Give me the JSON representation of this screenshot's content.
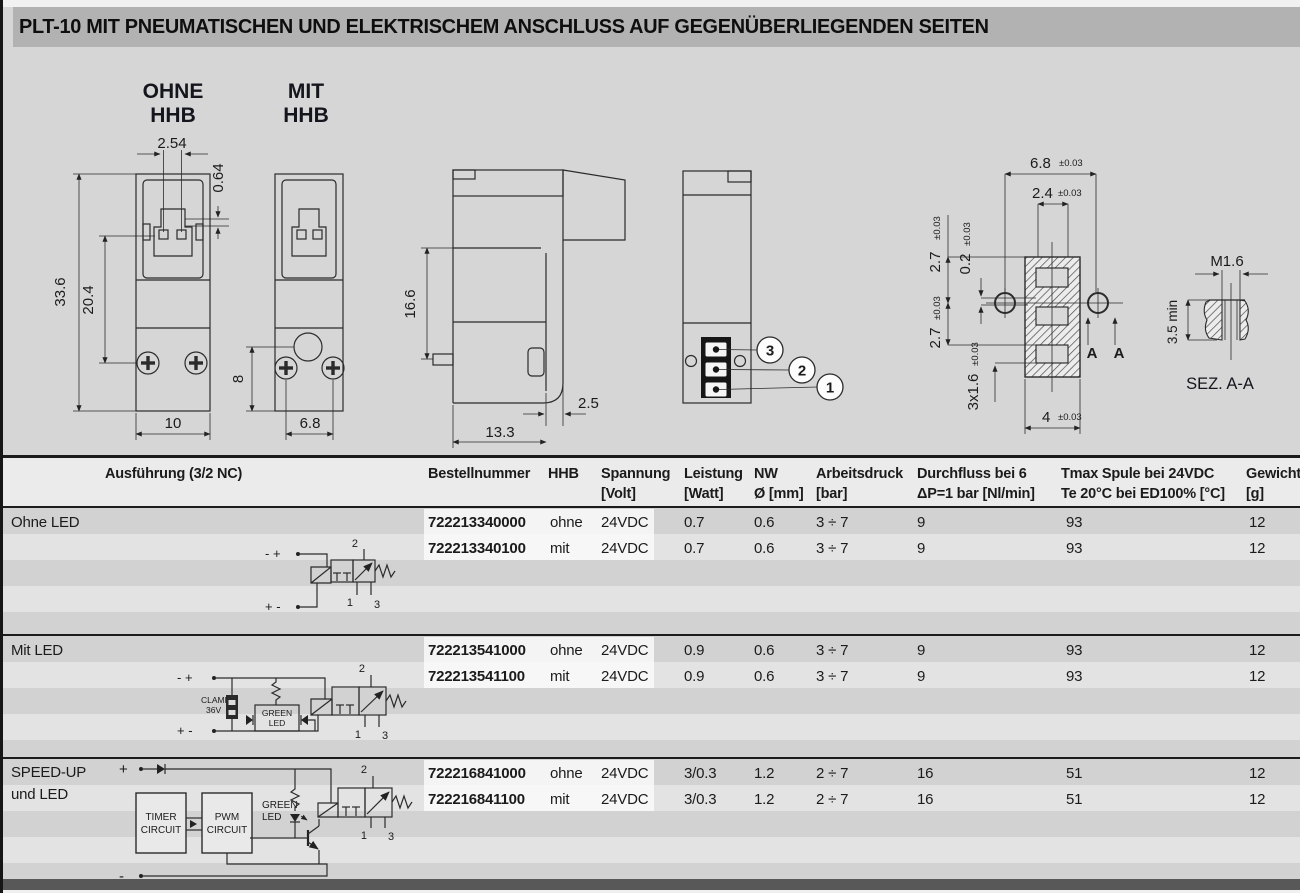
{
  "page": {
    "title": "PLT-10 MIT PNEUMATISCHEN UND ELEKTRISCHEM ANSCHLUSS AUF GEGENÜBERLIEGENDEN SEITEN"
  },
  "drawings": {
    "ohne": {
      "label1": "OHNE",
      "label2": "HHB",
      "dim_pin_spacing": "2.54",
      "dim_pin_height": "0.64",
      "dim_height": "33.6",
      "dim_inner_height": "20.4",
      "dim_width": "10"
    },
    "mit": {
      "label1": "MIT",
      "label2": "HHB",
      "dim_screw_offset": "8",
      "dim_screw_spacing": "6.8"
    },
    "side": {
      "dim_height": "16.6",
      "dim_offset": "2.5",
      "dim_depth": "13.3"
    },
    "ports": {
      "callout_3": "3",
      "callout_2": "2",
      "callout_1": "1"
    },
    "pattern": {
      "outer": {
        "v": "6.8",
        "tol": "±0.03"
      },
      "inner": {
        "v": "2.4",
        "tol": "±0.03"
      },
      "p1": {
        "v": "2.7",
        "tol": "±0.03"
      },
      "gap": {
        "v": "0.2",
        "tol": "±0.03"
      },
      "p2": {
        "v": "2.7",
        "tol": "±0.03"
      },
      "slots": {
        "v": "3x1.6",
        "tol": "±0.03"
      },
      "base": {
        "v": "4",
        "tol": "±0.03"
      },
      "sec_a1": "A",
      "sec_a2": "A"
    },
    "section": {
      "thread": "M1.6",
      "depth": "3.5 min",
      "caption": "SEZ. A-A"
    }
  },
  "schematics": {
    "s1": {
      "term_top": "- +",
      "term_bottom": "+ -",
      "port2": "2",
      "port1": "1",
      "port3": "3"
    },
    "s2": {
      "term_top": "- +",
      "term_bottom": "+ -",
      "clamp1": "CLAMP",
      "clamp2": "36V",
      "led1": "GREEN",
      "led2": "LED",
      "port2": "2",
      "port1": "1",
      "port3": "3"
    },
    "s3": {
      "term_top": "+",
      "term_bottom": "-",
      "timer1": "TIMER",
      "timer2": "CIRCUIT",
      "pwm1": "PWM",
      "pwm2": "CIRCUIT",
      "led1": "GREEN",
      "led2": "LED",
      "port2": "2",
      "port1": "1",
      "port3": "3"
    }
  },
  "table": {
    "headers": {
      "ausfuehrung": "Ausführung (3/2 NC)",
      "bestellnummer": "Bestellnummer",
      "hhb": "HHB",
      "spannung1": "Spannung",
      "spannung2": "[Volt]",
      "leistung1": "Leistung",
      "leistung2": "[Watt]",
      "nw1": "NW",
      "nw2": "Ø [mm]",
      "druck1": "Arbeitsdruck",
      "druck2": "[bar]",
      "fluss1": "Durchfluss bei 6",
      "fluss2": "ΔP=1 bar [Nl/min]",
      "tmax1": "Tmax Spule bei 24VDC",
      "tmax2": "Te 20°C bei  ED100% [°C]",
      "gewicht1": "Gewicht",
      "gewicht2": "[g]"
    },
    "groups": [
      {
        "label1": "Ohne LED",
        "label2": "",
        "rows": [
          {
            "nr": "722213340000",
            "hhb": "ohne",
            "volt": "24VDC",
            "watt": "0.7",
            "nw": "0.6",
            "bar": "3 ÷ 7",
            "fluss": "9",
            "tmax": "93",
            "gewicht": "12"
          },
          {
            "nr": "722213340100",
            "hhb": "mit",
            "volt": "24VDC",
            "watt": "0.7",
            "nw": "0.6",
            "bar": "3 ÷ 7",
            "fluss": "9",
            "tmax": "93",
            "gewicht": "12"
          }
        ]
      },
      {
        "label1": "Mit LED",
        "label2": "",
        "rows": [
          {
            "nr": "722213541000",
            "hhb": "ohne",
            "volt": "24VDC",
            "watt": "0.9",
            "nw": "0.6",
            "bar": "3 ÷ 7",
            "fluss": "9",
            "tmax": "93",
            "gewicht": "12"
          },
          {
            "nr": "722213541100",
            "hhb": "mit",
            "volt": "24VDC",
            "watt": "0.9",
            "nw": "0.6",
            "bar": "3 ÷ 7",
            "fluss": "9",
            "tmax": "93",
            "gewicht": "12"
          }
        ]
      },
      {
        "label1": "SPEED-UP",
        "label2": "und LED",
        "rows": [
          {
            "nr": "722216841000",
            "hhb": "ohne",
            "volt": "24VDC",
            "watt": "3/0.3",
            "nw": "1.2",
            "bar": "2 ÷ 7",
            "fluss": "16",
            "tmax": "51",
            "gewicht": "12"
          },
          {
            "nr": "722216841100",
            "hhb": "mit",
            "volt": "24VDC",
            "watt": "3/0.3",
            "nw": "1.2",
            "bar": "2 ÷ 7",
            "fluss": "16",
            "tmax": "51",
            "gewicht": "12"
          }
        ]
      }
    ]
  },
  "colors": {
    "page_bg": "#d6d6d6",
    "title_bg": "#b2b2b2",
    "row_dark": "#d2d2d2",
    "row_light": "#e3e3e3",
    "footer_bar": "#585858"
  }
}
